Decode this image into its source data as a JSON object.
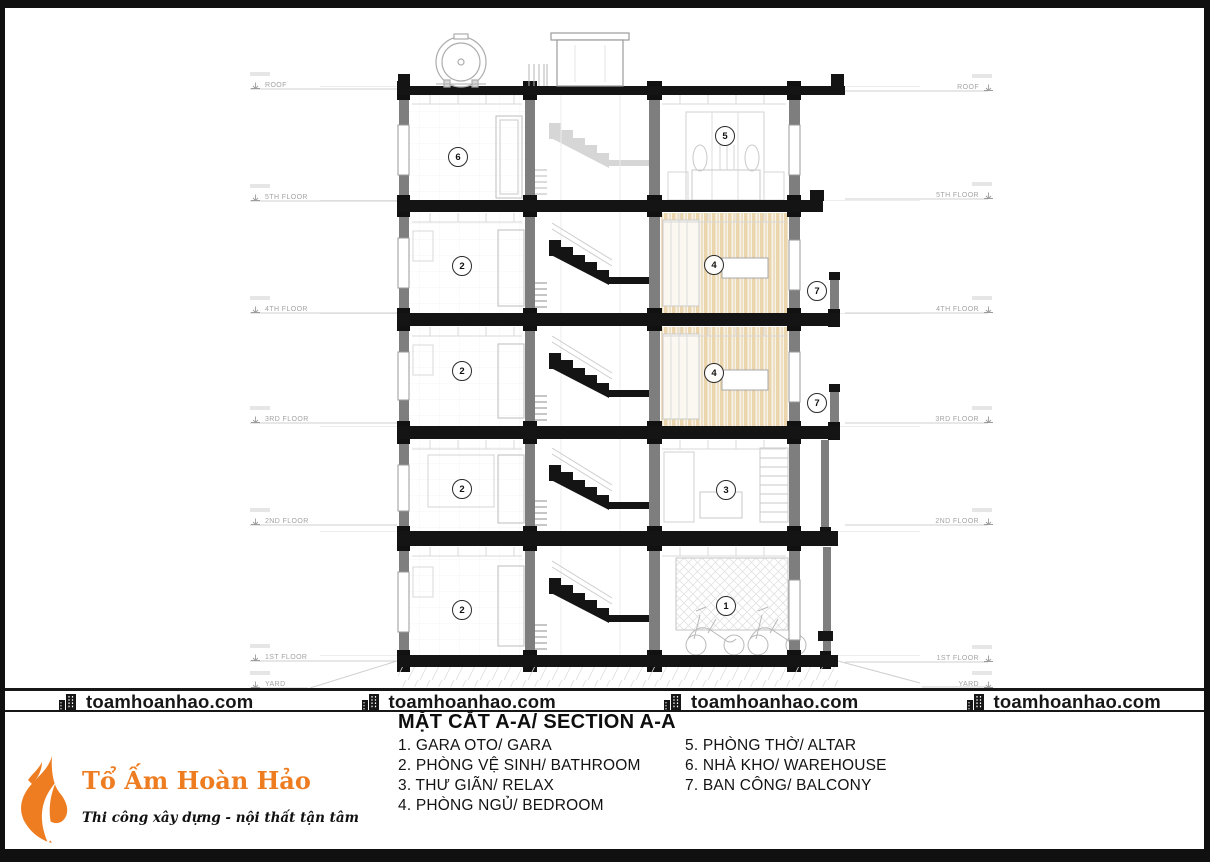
{
  "page": {
    "title": "MẶT CẮT A-A/ SECTION A-A"
  },
  "watermark": {
    "text": "toamhoanhao.com",
    "icon": "building-icon",
    "count": 4
  },
  "legend": {
    "items_left": [
      "1. GARA OTO/ GARA",
      "2. PHÒNG VỆ SINH/ BATHROOM",
      "3. THƯ GIÃN/ RELAX",
      "4. PHÒNG NGỦ/ BEDROOM"
    ],
    "items_right": [
      "5. PHÒNG THỜ/ ALTAR",
      "6. NHÀ KHO/ WAREHOUSE",
      "7. BAN CÔNG/ BALCONY"
    ]
  },
  "levels": {
    "left": [
      {
        "label": "ROOF",
        "y": 85
      },
      {
        "label": "5TH FLOOR",
        "y": 197
      },
      {
        "label": "4TH FLOOR",
        "y": 309
      },
      {
        "label": "3RD FLOOR",
        "y": 419
      },
      {
        "label": "2ND FLOOR",
        "y": 521
      },
      {
        "label": "1ST FLOOR",
        "y": 657
      },
      {
        "label": "YARD",
        "y": 684
      }
    ],
    "right": [
      {
        "label": "ROOF",
        "y": 87
      },
      {
        "label": "5TH FLOOR",
        "y": 195
      },
      {
        "label": "4TH FLOOR",
        "y": 309
      },
      {
        "label": "3RD FLOOR",
        "y": 419
      },
      {
        "label": "2ND FLOOR",
        "y": 521
      },
      {
        "label": "1ST FLOOR",
        "y": 658
      },
      {
        "label": "YARD",
        "y": 684
      }
    ]
  },
  "room_badges": [
    {
      "num": "6",
      "room": "warehouse",
      "x": 458,
      "y": 157
    },
    {
      "num": "5",
      "room": "altar",
      "x": 725,
      "y": 136
    },
    {
      "num": "2",
      "room": "bathroom",
      "x": 462,
      "y": 266
    },
    {
      "num": "4",
      "room": "bedroom",
      "x": 714,
      "y": 265
    },
    {
      "num": "7",
      "room": "balcony",
      "x": 817,
      "y": 291
    },
    {
      "num": "2",
      "room": "bathroom",
      "x": 462,
      "y": 371
    },
    {
      "num": "4",
      "room": "bedroom",
      "x": 714,
      "y": 373
    },
    {
      "num": "7",
      "room": "balcony",
      "x": 817,
      "y": 403
    },
    {
      "num": "2",
      "room": "bathroom",
      "x": 462,
      "y": 489
    },
    {
      "num": "3",
      "room": "relax",
      "x": 726,
      "y": 490
    },
    {
      "num": "2",
      "room": "bathroom",
      "x": 462,
      "y": 610
    },
    {
      "num": "1",
      "room": "gara",
      "x": 726,
      "y": 606
    }
  ],
  "logo": {
    "name": "Tổ Ấm Hoàn Hảo",
    "tagline": "Thi công xây dựng - nội thất tận tâm",
    "accent": "#ee7c21"
  },
  "colors": {
    "ink": "#141414",
    "wall_gray": "#7e7e7e",
    "faint": "#c9c9c9",
    "wood": "#ead5ad",
    "accent_orange": "#ee7c21"
  }
}
